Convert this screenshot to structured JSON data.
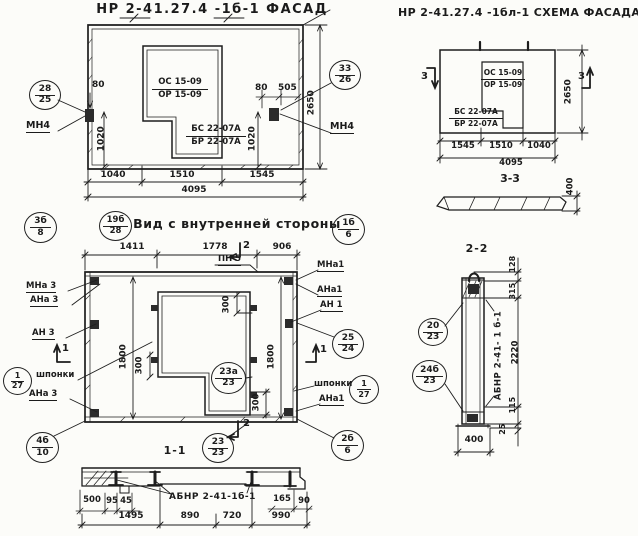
{
  "facade": {
    "title": "НР 2-41.27.4 -1б-1 ФАСАД",
    "marker_left": {
      "top": "28",
      "bottom": "25"
    },
    "marker_right": {
      "top": "33",
      "bottom": "26"
    },
    "anchor_left": "МН4",
    "anchor_right": "МН4",
    "dim_80_left": "80",
    "dim_80_right": "80",
    "dim_505": "505",
    "dim_1020_left": "1020",
    "dim_1020_right": "1020",
    "dim_2650": "2650",
    "opening_labels": {
      "os": "ОС 15-09",
      "or": "ОР 15-09",
      "bs": "БС 22-07А",
      "br": "БР 22-07А"
    },
    "dims_bottom": [
      "1040",
      "1510",
      "1545"
    ],
    "dim_total": "4095"
  },
  "scheme": {
    "title": "НР 2-41.27.4 -1бл-1 СХЕМА ФАСАДА",
    "section_mark": "3",
    "opening_labels": {
      "os": "ОС 15-09",
      "or": "ОР 15-09",
      "bs": "БС 22-07А",
      "br": "БР 22-07А"
    },
    "dim_2650": "2650",
    "dims_bottom": [
      "1545",
      "1510",
      "1040"
    ],
    "dim_total": "4095",
    "section_view": {
      "label": "3-3",
      "dim_400": "400"
    }
  },
  "inner": {
    "title": "Вид с внутренней стороны",
    "marker_3b8": {
      "top": "3б",
      "bottom": "8"
    },
    "marker_19b28": {
      "top": "19б",
      "bottom": "28"
    },
    "marker_1b6": {
      "top": "1б",
      "bottom": "6"
    },
    "dims_top": [
      "1411",
      "1778",
      "906"
    ],
    "pn5": "ПН 5",
    "mark_1": "1",
    "mark_2": "2",
    "left": {
      "mna": "МНа 3",
      "ana_top": "АНа 3",
      "an": "АН 3",
      "shponki": "шпонки",
      "ana_bottom": "АНа 3",
      "marker_keys": {
        "top": "1",
        "bottom": "27"
      },
      "marker_corner": {
        "top": "4б",
        "bottom": "10"
      }
    },
    "right": {
      "mna": "МНа1",
      "ana_top": "АНа1",
      "an": "АН 1",
      "shponki": "шпонки",
      "ana_bottom": "АНа1",
      "marker_25_24": {
        "top": "25",
        "bottom": "24"
      },
      "marker_keys": {
        "top": "1",
        "bottom": "27"
      },
      "marker_corner": {
        "top": "2б",
        "bottom": "6"
      }
    },
    "marker_23a_23": {
      "top": "23а",
      "bottom": "23"
    },
    "marker_23_23": {
      "top": "23",
      "bottom": "23"
    },
    "dim_300_top": "300",
    "dim_300_left": "300",
    "dim_300_bottom": "300",
    "dim_1800_left": "1800",
    "dim_1800_right": "1800"
  },
  "section_1_1": {
    "title": "1-1",
    "part_label": "АБНР 2-41-1б-1",
    "dims_small": [
      "500",
      "95",
      "45"
    ],
    "dims_bottom": [
      "1495",
      "890",
      "720",
      "990"
    ],
    "dim_165": "165",
    "dim_90": "90"
  },
  "section_2_2": {
    "title": "2-2",
    "part_label": "АБНР 2-41- 1 б-1",
    "marker_20_23": {
      "top": "20",
      "bottom": "23"
    },
    "marker_24b_23": {
      "top": "24б",
      "bottom": "23"
    },
    "dim_128": "128",
    "dim_315": "315",
    "dim_2220": "2220",
    "dim_115": "115",
    "dim_25": "25",
    "dim_400": "400"
  }
}
